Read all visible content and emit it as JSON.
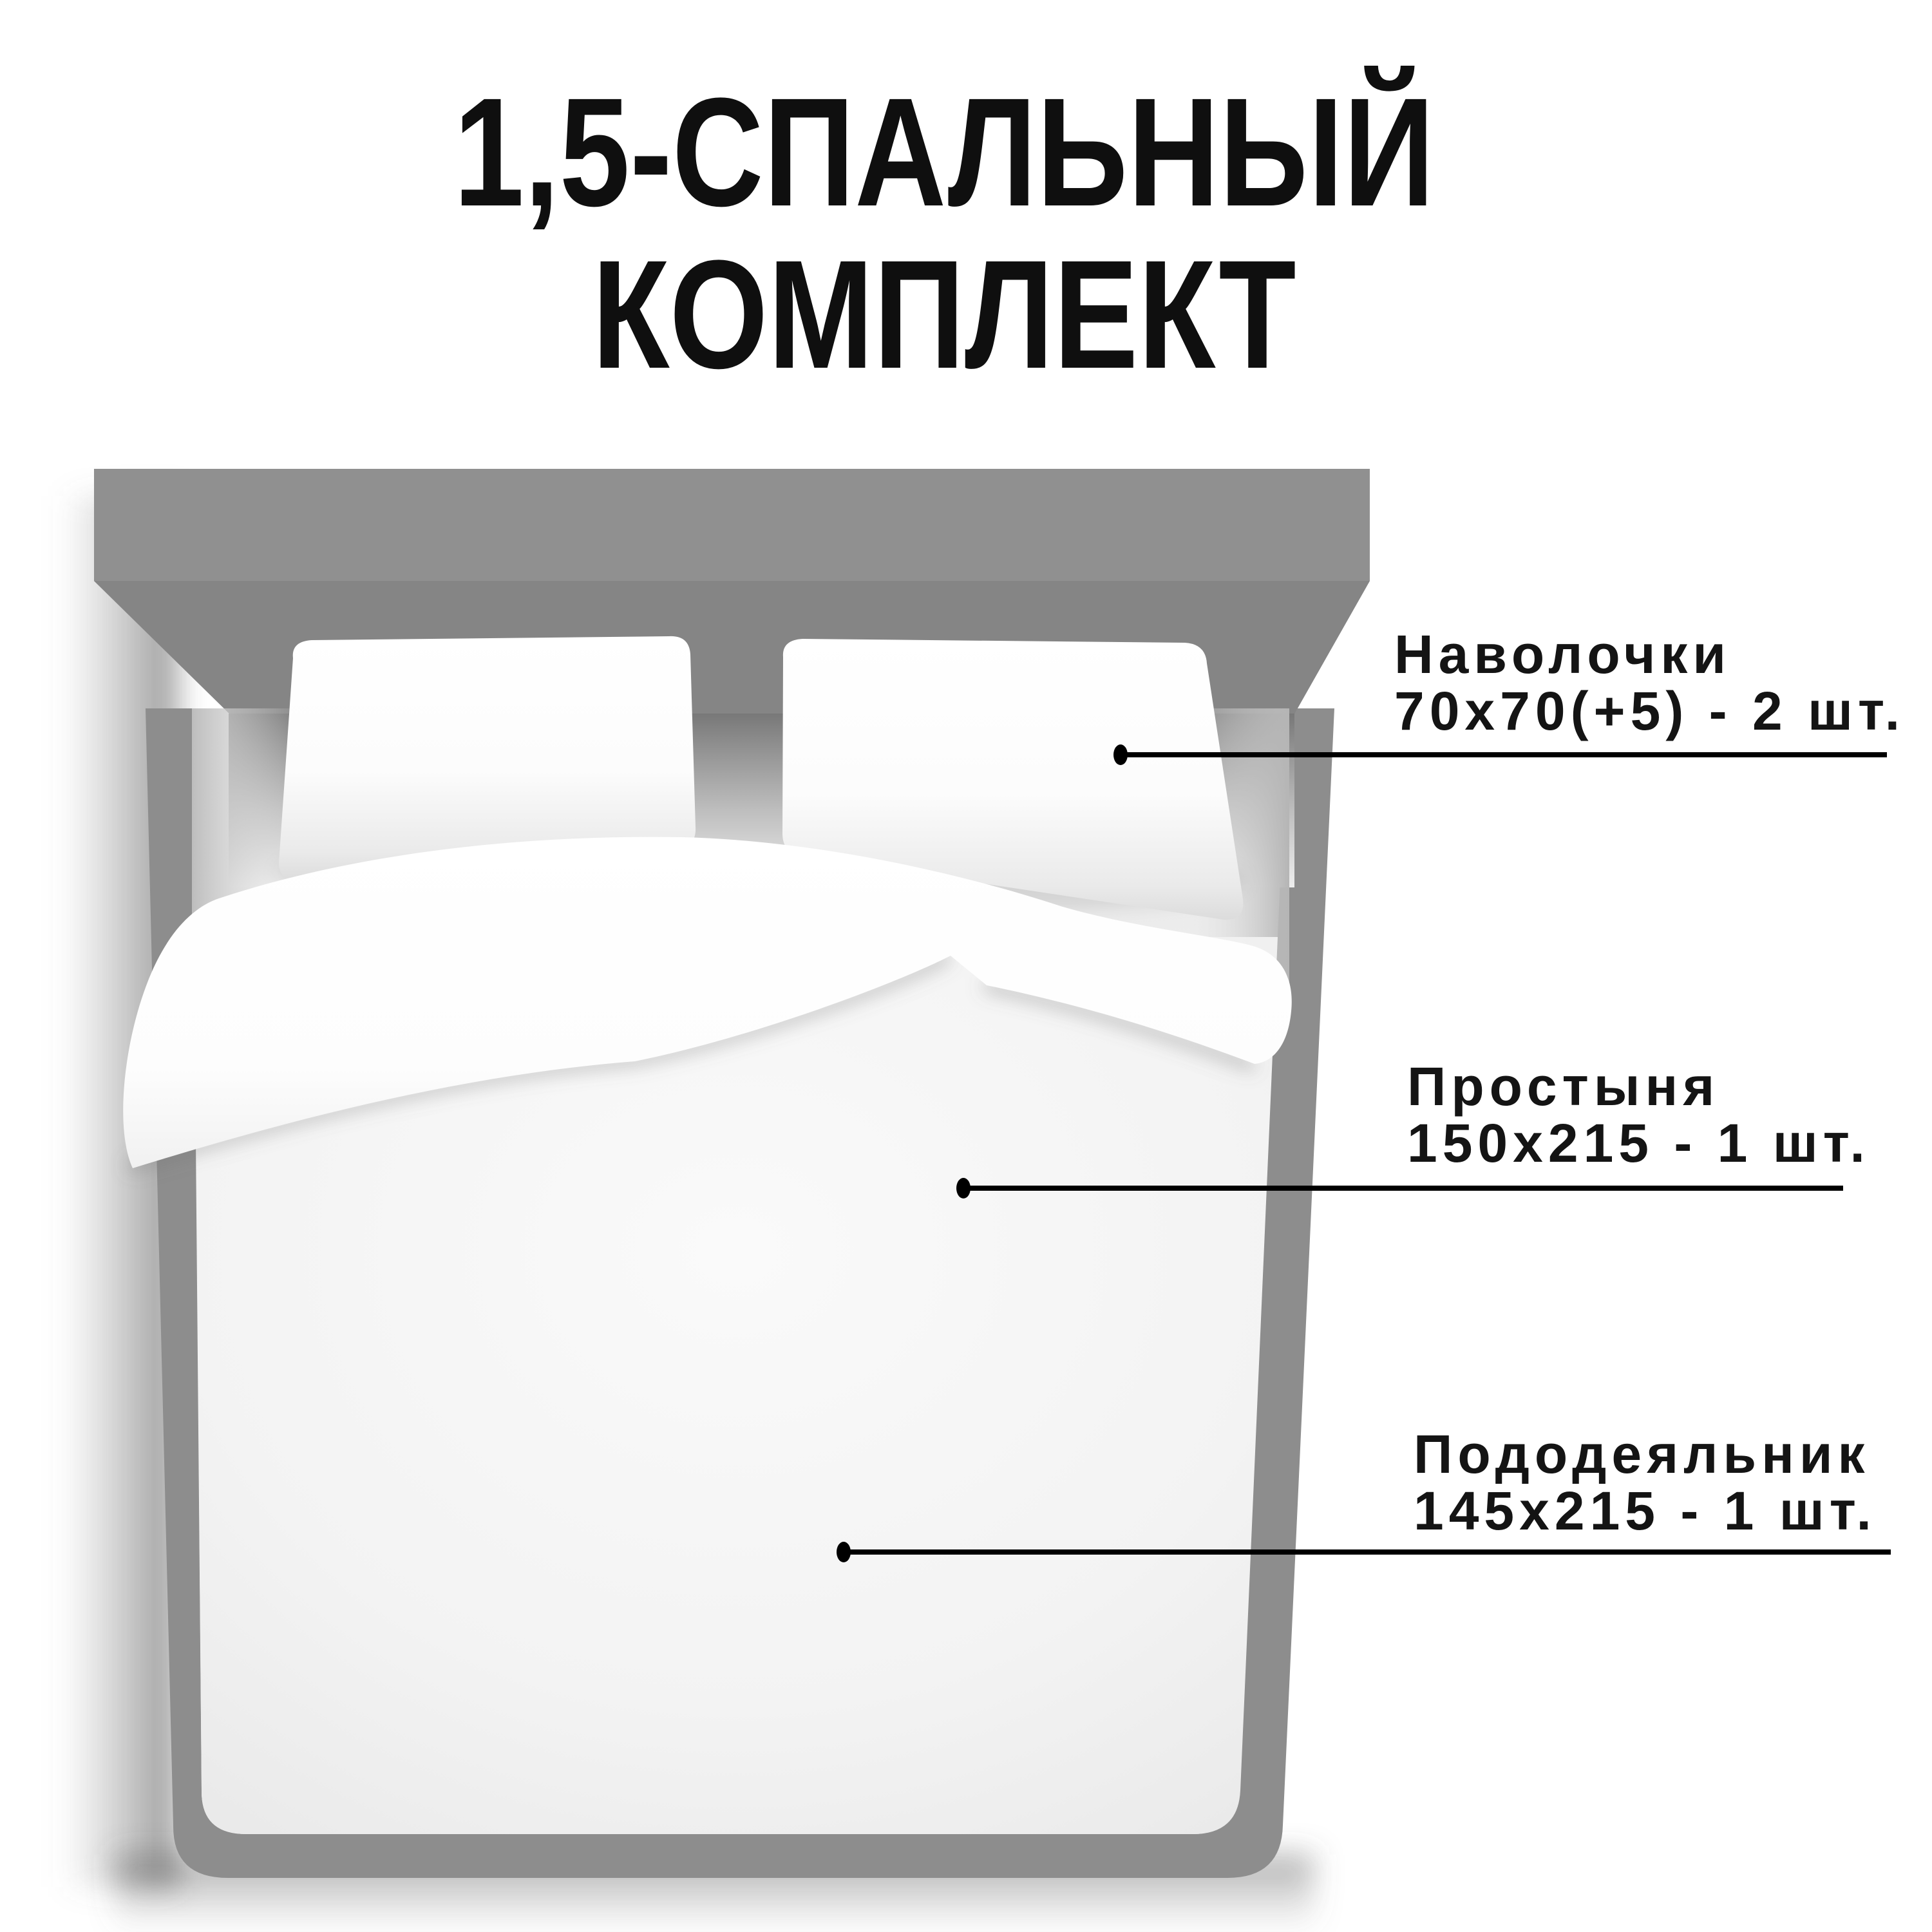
{
  "title": {
    "line1": "1,5-СПАЛЬНЫЙ",
    "line2": "КОМПЛЕКТ"
  },
  "annotations": [
    {
      "label": "Наволочки",
      "size": "70х70(+5) - 2 шт."
    },
    {
      "label": "Простыня",
      "size": "150х215 - 1 шт."
    },
    {
      "label": "Пододеяльник",
      "size": "145х215 - 1 шт."
    }
  ],
  "colors": {
    "background": "#ffffff",
    "text": "#101010",
    "bed_gray": "#8d8d8d",
    "callout_line": "#000000"
  }
}
